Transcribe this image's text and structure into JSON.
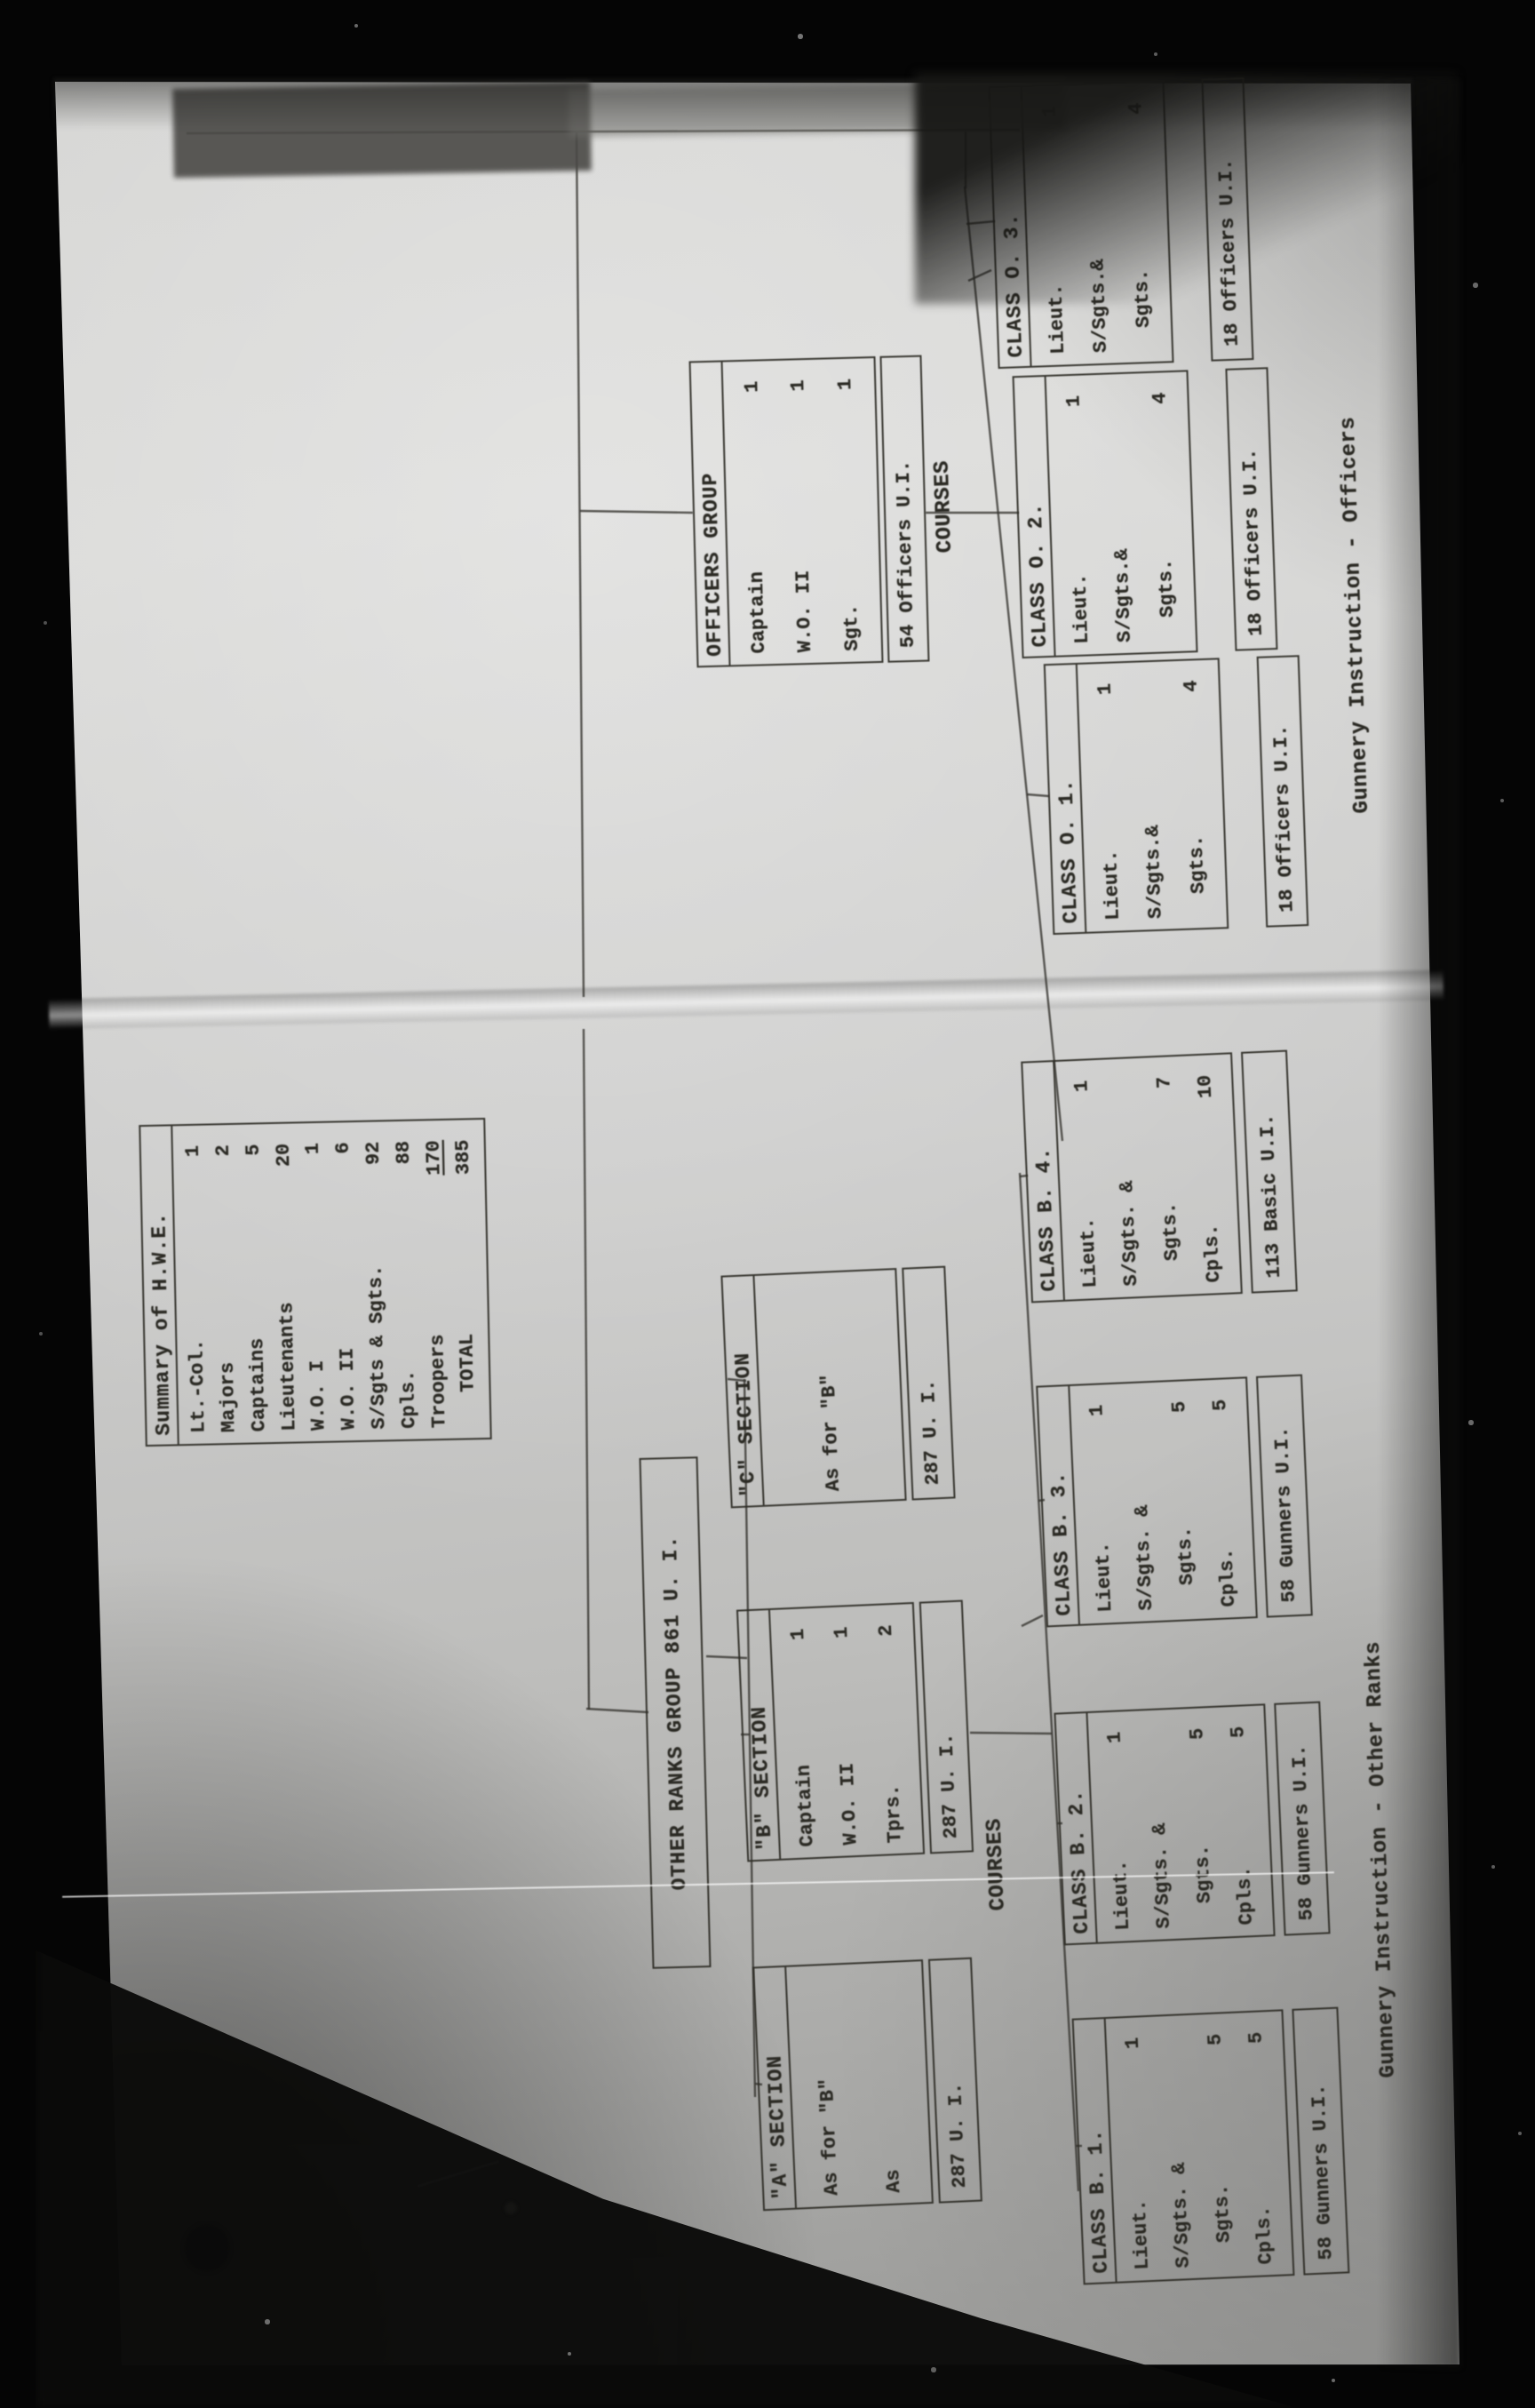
{
  "summary": {
    "title": "Summary of H.W.E.",
    "rows": [
      [
        "Lt.-Col.",
        "1"
      ],
      [
        "Majors",
        "2"
      ],
      [
        "Captains",
        "5"
      ],
      [
        "Lieutenants",
        "20"
      ],
      [
        "W.O. I",
        "1"
      ],
      [
        "W.O. II",
        "6"
      ],
      [
        "S/Sgts & Sgts.",
        "92"
      ],
      [
        "Cpls.",
        "88"
      ],
      [
        "Troopers",
        "170",
        "u"
      ],
      [
        "   TOTAL",
        "385"
      ]
    ]
  },
  "officers_group": {
    "header": "OFFICERS GROUP",
    "rows": [
      [
        "Captain",
        "1"
      ],
      [
        "W.O. II",
        "1"
      ],
      [
        "Sgt.",
        "1"
      ]
    ],
    "strip": "54 Officers U.I."
  },
  "courses_label_officers": "COURSES",
  "officer_classes": [
    {
      "header": "CLASS O. 1.",
      "rows": [
        [
          "Lieut.",
          "1"
        ],
        [
          "S/Sgts.&",
          ""
        ],
        [
          "  Sgts.",
          "4"
        ]
      ],
      "strip": "18 Officers U.I."
    },
    {
      "header": "CLASS O. 2.",
      "rows": [
        [
          "Lieut.",
          "1"
        ],
        [
          "S/Sgts.&",
          ""
        ],
        [
          "  Sgts.",
          "4"
        ]
      ],
      "strip": "18 Officers U.I."
    },
    {
      "header": "CLASS O. 3.",
      "rows": [
        [
          "Lieut.",
          "1"
        ],
        [
          "S/Sgts.&",
          ""
        ],
        [
          "  Sgts.",
          "4"
        ]
      ],
      "strip": "18 Officers U.I."
    }
  ],
  "officers_caption": "Gunnery Instruction - Officers",
  "other_ranks_title": "OTHER RANKS GROUP 861 U. I.",
  "sections": [
    {
      "header": "\"A\" SECTION",
      "rows": [
        [
          "As for \"B\"",
          ""
        ],
        [
          "As",
          ""
        ]
      ],
      "strip": "287 U. I."
    },
    {
      "header": "\"B\" SECTION",
      "rows": [
        [
          "Captain",
          "1"
        ],
        [
          "W.O. II",
          "1"
        ],
        [
          "Tprs.",
          "2"
        ]
      ],
      "strip": "287 U. I."
    },
    {
      "header": "\"C\" SECTION",
      "rows": [
        [
          "As for \"B\"",
          ""
        ]
      ],
      "strip": "287 U. I."
    }
  ],
  "courses_label_other_ranks": "COURSES",
  "or_classes": [
    {
      "header": "CLASS B. 1.",
      "rows": [
        [
          "Lieut.",
          "1"
        ],
        [
          "S/Sgts. &",
          ""
        ],
        [
          "  Sgts.",
          "5"
        ],
        [
          "Cpls.",
          "5"
        ]
      ],
      "strip": "58 Gunners U.I."
    },
    {
      "header": "CLASS B. 2.",
      "rows": [
        [
          "Lieut.",
          "1"
        ],
        [
          "S/Sgts. &",
          ""
        ],
        [
          "  Sgts.",
          "5"
        ],
        [
          "Cpls.",
          "5"
        ]
      ],
      "strip": "58 Gunners U.I."
    },
    {
      "header": "CLASS B. 3.",
      "rows": [
        [
          "Lieut.",
          "1"
        ],
        [
          "S/Sgts. &",
          ""
        ],
        [
          "  Sgts.",
          "5"
        ],
        [
          "Cpls.",
          "5"
        ]
      ],
      "strip": "58 Gunners U.I."
    },
    {
      "header": "CLASS B. 4.",
      "rows": [
        [
          "Lieut.",
          "1"
        ],
        [
          "S/Sgts. &",
          ""
        ],
        [
          "  Sgts.",
          "7"
        ],
        [
          "Cpls.",
          "10"
        ]
      ],
      "strip": "113 Basic U.I."
    }
  ],
  "other_ranks_caption": "Gunnery Instruction - Other Ranks"
}
